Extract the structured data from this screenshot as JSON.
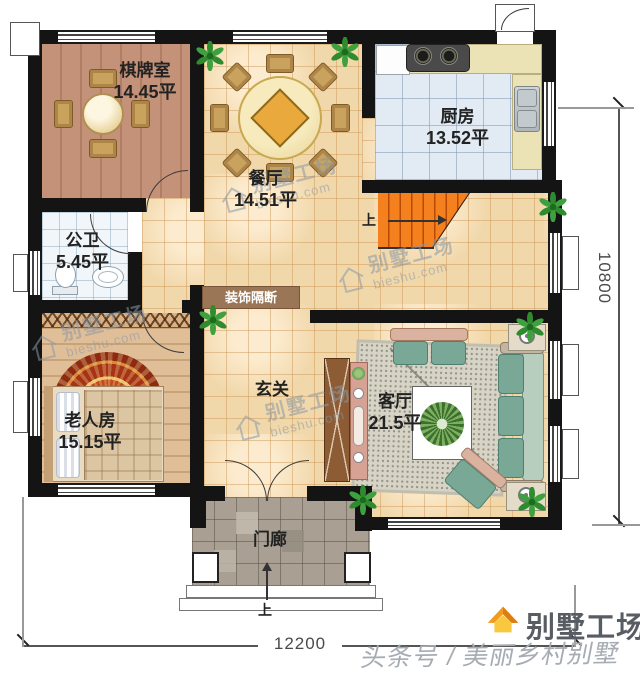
{
  "plan": {
    "rooms": [
      {
        "name": "棋牌室",
        "area": "14.45平"
      },
      {
        "name": "餐厅",
        "area": "14.51平"
      },
      {
        "name": "厨房",
        "area": "13.52平"
      },
      {
        "name": "公卫",
        "area": "5.45平"
      },
      {
        "name": "老人房",
        "area": "15.15平"
      },
      {
        "name": "玄关",
        "area": ""
      },
      {
        "name": "客厅",
        "area": "21.5平"
      },
      {
        "name": "门廊",
        "area": ""
      }
    ],
    "partition_label": "装饰隔断",
    "stair_up_label": "上",
    "entry_up_label": "上",
    "dimensions": {
      "width": "12200",
      "height": "10800"
    }
  },
  "watermark": {
    "brand": "别墅工场",
    "site": "bieshu.com"
  },
  "footer": {
    "credit": "头条号 / 美丽乡村别墅",
    "logo_text": "别墅工场"
  },
  "colors": {
    "wall": "#141414",
    "stair": "#f5801e",
    "banner": "#9b7656",
    "logo_orange": "#ef9c1f"
  }
}
